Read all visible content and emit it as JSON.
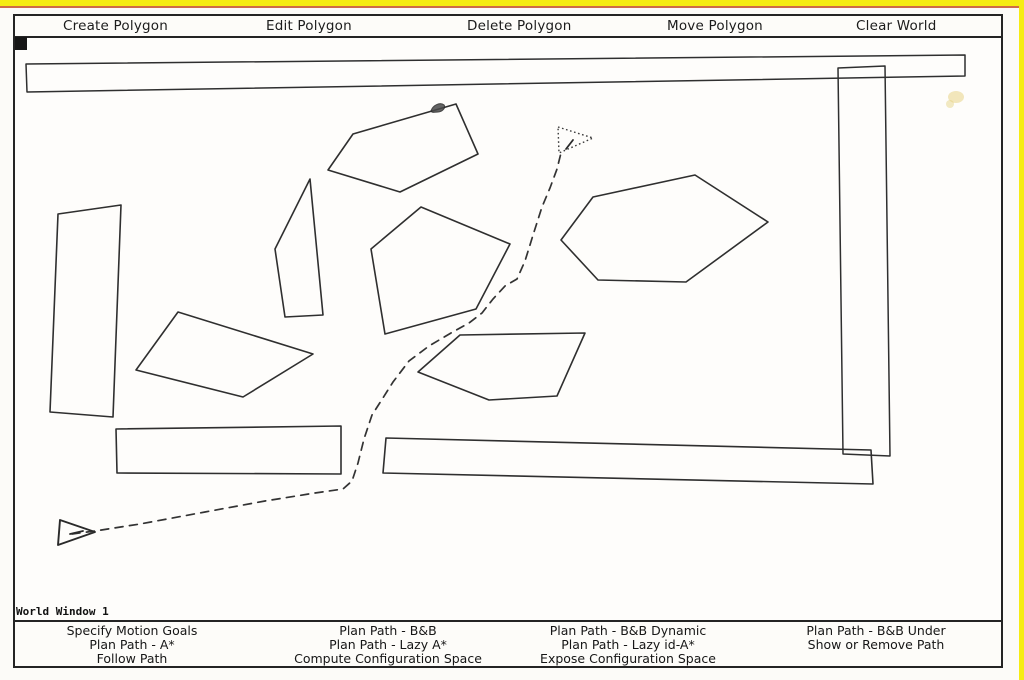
{
  "window": {
    "title": "World Window 1"
  },
  "top_menu": {
    "items": [
      {
        "label": "Create Polygon"
      },
      {
        "label": "Edit Polygon"
      },
      {
        "label": "Delete Polygon"
      },
      {
        "label": "Move Polygon"
      },
      {
        "label": "Clear World"
      }
    ]
  },
  "bottom_menu": {
    "columns": [
      {
        "items": [
          "Specify Motion Goals",
          "Plan Path - A*",
          "Follow Path"
        ]
      },
      {
        "items": [
          "Plan Path - B&B",
          "Plan Path - Lazy A*",
          "Compute Configuration Space"
        ]
      },
      {
        "items": [
          "Plan Path - B&B Dynamic",
          "Plan Path - Lazy id-A*",
          "Expose Configuration Space"
        ]
      },
      {
        "items": [
          "Plan Path - B&B Under",
          "Show or Remove Path"
        ]
      }
    ]
  },
  "canvas": {
    "polygons": [
      {
        "name": "top wall slab",
        "points": "26,62 965,53 965,74 27,90"
      },
      {
        "name": "right wall slab",
        "points": "838,66 885,64 890,454 843,452"
      },
      {
        "name": "left tall slab",
        "points": "58,212 121,203 113,415 50,410"
      },
      {
        "name": "top pentagon",
        "points": "328,168 353,132 456,102 478,152 400,190"
      },
      {
        "name": "thin sliver",
        "points": "310,177 275,247 285,315 323,313"
      },
      {
        "name": "center pentagon",
        "points": "371,247 421,205 510,242 476,307 385,332"
      },
      {
        "name": "right hexagon",
        "points": "561,238 593,195 695,173 768,220 686,280 598,278"
      },
      {
        "name": "left quadrilateral",
        "points": "178,310 313,352 243,395 136,368"
      },
      {
        "name": "lower pentagon",
        "points": "418,370 460,333 585,331 557,394 489,398"
      },
      {
        "name": "lower left rectangle",
        "points": "116,427 341,424 341,472 117,471"
      },
      {
        "name": "lower long rectangle",
        "points": "386,436 871,448 873,482 383,471"
      }
    ],
    "path": {
      "style": "dashed",
      "d": "M72,532 L95,529 L140,522 L205,510 L265,499 L315,491 L343,487 L352,479 L358,461 L364,437 L372,413 L381,399 L393,380 L409,359 L429,344 L451,331 L469,321 L482,311 L493,297 L505,284 L517,277 L525,259 L534,230 L542,205 L550,186 L557,167 L561,151"
    },
    "start_marker": {
      "points": "60,518 58,543 95,530",
      "heading_dash": "M70,532 L83,529",
      "style": "solid outline, points right"
    },
    "goal_marker": {
      "points": "558,125 593,136 559,151",
      "heading_dash": "M566,147 L573,138",
      "style": "dotted outline, points right"
    },
    "scribble_mark": {
      "d": "M431,109 C433,103 440,100 444,103 C446,105 443,110 437,110 C434,110 432,111 431,109 Z"
    },
    "stain": {
      "cx1": "956",
      "cy1": "95",
      "cx2": "950",
      "cy2": "102"
    }
  },
  "colors": {
    "line": "#2f2f2f",
    "edge_yellow": "#f6ec13",
    "edge_red": "#cf6b47",
    "stain": "#e5d07c",
    "background": "#fefdfb"
  }
}
